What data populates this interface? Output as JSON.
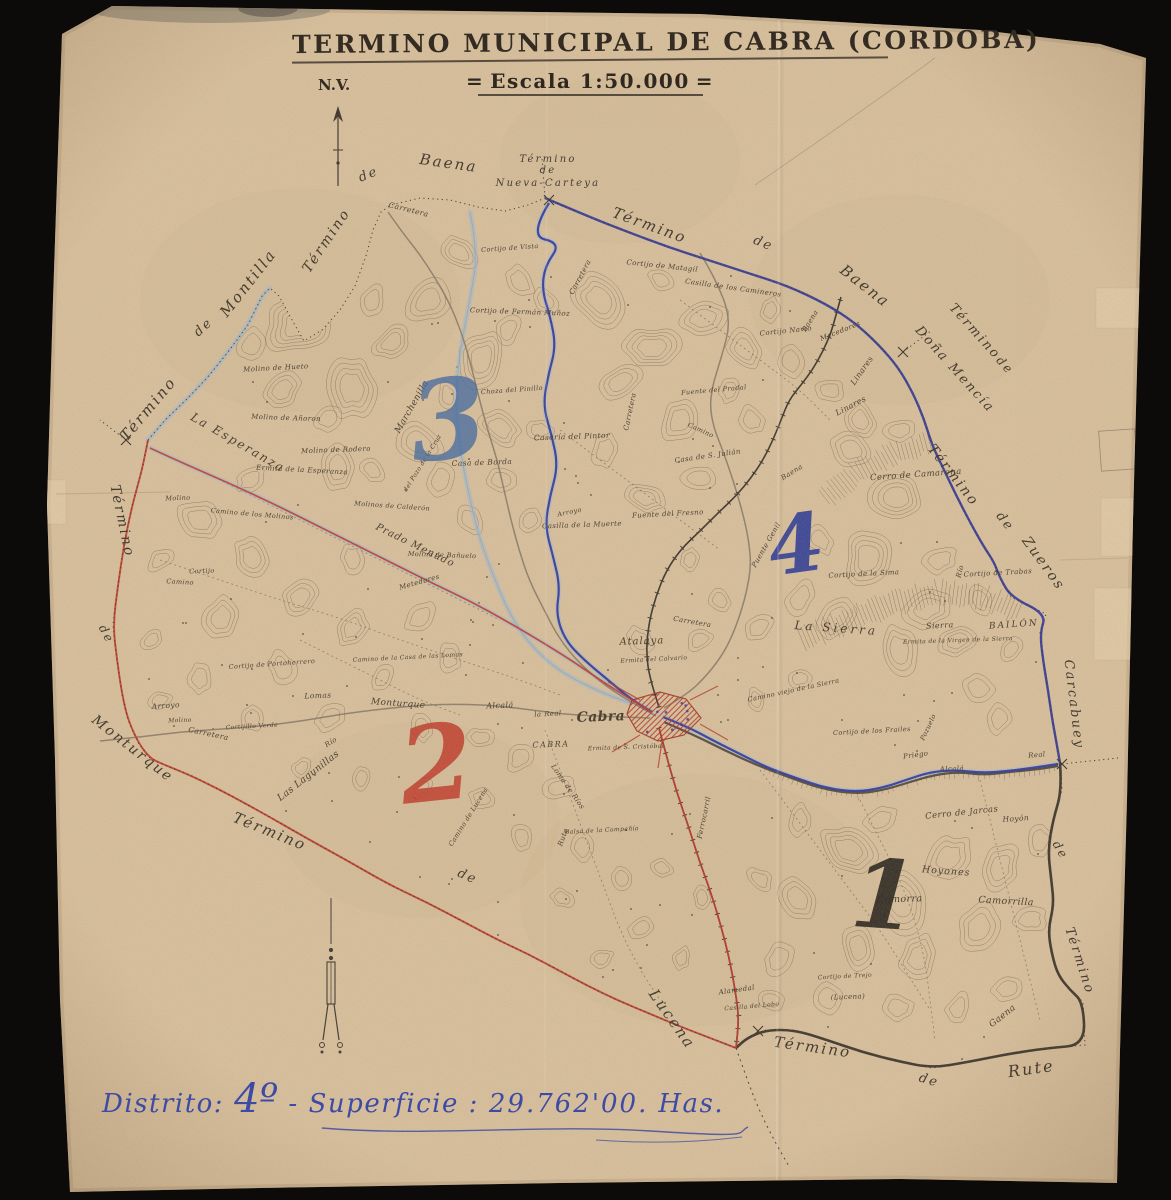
{
  "document": {
    "title": "TERMINO MUNICIPAL DE CABRA (CORDOBA)",
    "scale": "Escala 1:50.000",
    "scale_decor": "=",
    "north_indicator": "N.V."
  },
  "footer": {
    "prefix": "Distrito:",
    "district": "4º",
    "separator": "-",
    "surface_label": "Superficie :",
    "surface_value": "29.762'00.",
    "unit": "Has."
  },
  "map": {
    "colors": {
      "background": "#0c0b09",
      "paper": "#d9c19f",
      "ink": "#443a2d",
      "contour": "#86715a",
      "boundary_blue": "#2c35a0",
      "boundary_red": "#c23a2c",
      "boundary_black": "#37302a",
      "stream_blue": "#9fb9d4",
      "road": "#877a67",
      "footer_ink": "#3e4ba5"
    },
    "districts": [
      {
        "label": "1",
        "x": 882,
        "y": 928,
        "size": 95,
        "rot": 4,
        "color": "#2a2520",
        "opacity": 0.92
      },
      {
        "label": "2",
        "x": 440,
        "y": 800,
        "size": 105,
        "rot": -6,
        "color": "#c23a2c",
        "opacity": 0.85
      },
      {
        "label": "3",
        "x": 452,
        "y": 458,
        "size": 110,
        "rot": -6,
        "color": "#4169a4",
        "opacity": 0.78
      },
      {
        "label": "4",
        "x": 800,
        "y": 572,
        "size": 80,
        "rot": -8,
        "color": "#2b3a99",
        "opacity": 0.9
      }
    ],
    "neighbor_labels": [
      {
        "t": "Término",
        "x": 152,
        "y": 412,
        "r": -50,
        "s": 15
      },
      {
        "t": "de",
        "x": 206,
        "y": 330,
        "r": -42,
        "s": 13
      },
      {
        "t": "Montilla",
        "x": 252,
        "y": 286,
        "r": -52,
        "s": 15
      },
      {
        "t": "Término",
        "x": 330,
        "y": 243,
        "r": -56,
        "s": 14
      },
      {
        "t": "de",
        "x": 370,
        "y": 178,
        "r": -22,
        "s": 13
      },
      {
        "t": "Baena",
        "x": 448,
        "y": 168,
        "r": 8,
        "s": 15
      },
      {
        "t": "Término",
        "x": 548,
        "y": 162,
        "r": 0,
        "s": 10
      },
      {
        "t": "de",
        "x": 548,
        "y": 173,
        "r": 0,
        "s": 10
      },
      {
        "t": "Nueva-Carteya",
        "x": 548,
        "y": 186,
        "r": 0,
        "s": 10
      },
      {
        "t": "Término",
        "x": 648,
        "y": 230,
        "r": 20,
        "s": 15
      },
      {
        "t": "de",
        "x": 762,
        "y": 247,
        "r": 22,
        "s": 13
      },
      {
        "t": "Baena",
        "x": 862,
        "y": 290,
        "r": 38,
        "s": 15
      },
      {
        "t": "Término",
        "x": 972,
        "y": 334,
        "r": 48,
        "s": 13
      },
      {
        "t": "de",
        "x": 1002,
        "y": 368,
        "r": 48,
        "s": 12
      },
      {
        "t": "Doña Mencía",
        "x": 952,
        "y": 372,
        "r": 48,
        "s": 13
      },
      {
        "t": "Término",
        "x": 950,
        "y": 478,
        "r": 52,
        "s": 14
      },
      {
        "t": "de",
        "x": 1002,
        "y": 524,
        "r": 52,
        "s": 13
      },
      {
        "t": "Zueros",
        "x": 1040,
        "y": 566,
        "r": 54,
        "s": 14
      },
      {
        "t": "Carcabuey",
        "x": 1070,
        "y": 705,
        "r": 83,
        "s": 13
      },
      {
        "t": "de",
        "x": 1057,
        "y": 852,
        "r": 60,
        "s": 12
      },
      {
        "t": "Término",
        "x": 1076,
        "y": 962,
        "r": 72,
        "s": 13
      },
      {
        "t": "Término",
        "x": 812,
        "y": 1052,
        "r": 8,
        "s": 15
      },
      {
        "t": "de",
        "x": 928,
        "y": 1084,
        "r": 16,
        "s": 13
      },
      {
        "t": "Rute",
        "x": 1032,
        "y": 1074,
        "r": -8,
        "s": 16
      },
      {
        "t": "Término",
        "x": 268,
        "y": 836,
        "r": 22,
        "s": 15
      },
      {
        "t": "de",
        "x": 466,
        "y": 880,
        "r": 24,
        "s": 13
      },
      {
        "t": "Lucena",
        "x": 668,
        "y": 1022,
        "r": 55,
        "s": 15
      },
      {
        "t": "Término",
        "x": 118,
        "y": 522,
        "r": 78,
        "s": 14
      },
      {
        "t": "de",
        "x": 103,
        "y": 636,
        "r": 62,
        "s": 12
      },
      {
        "t": "Monturque",
        "x": 130,
        "y": 752,
        "r": 38,
        "s": 14
      }
    ],
    "place_labels": [
      {
        "t": "Carretera",
        "x": 408,
        "y": 212,
        "r": 14,
        "s": 7.5
      },
      {
        "t": "Cortijo de Vista",
        "x": 510,
        "y": 250,
        "r": -4,
        "s": 6.5
      },
      {
        "t": "Carretera",
        "x": 582,
        "y": 278,
        "r": -62,
        "s": 7
      },
      {
        "t": "Cortijo de Matagil",
        "x": 662,
        "y": 268,
        "r": 6,
        "s": 7
      },
      {
        "t": "Casilla de los Camineros",
        "x": 733,
        "y": 290,
        "r": 8,
        "s": 7
      },
      {
        "t": "Cortijo Navío",
        "x": 786,
        "y": 333,
        "r": -6,
        "s": 7
      },
      {
        "t": "Mecedores",
        "x": 841,
        "y": 333,
        "r": -22,
        "s": 7
      },
      {
        "t": "Baena",
        "x": 812,
        "y": 322,
        "r": -58,
        "s": 7
      },
      {
        "t": "Linares",
        "x": 864,
        "y": 372,
        "r": -55,
        "s": 8
      },
      {
        "t": "Linares",
        "x": 852,
        "y": 408,
        "r": -28,
        "s": 8
      },
      {
        "t": "Cortijo de Fermán Muñoz",
        "x": 520,
        "y": 314,
        "r": 2,
        "s": 7
      },
      {
        "t": "Molino de Hueto",
        "x": 276,
        "y": 370,
        "r": -3,
        "s": 7
      },
      {
        "t": "Molino de Añoron",
        "x": 286,
        "y": 420,
        "r": 2,
        "s": 7
      },
      {
        "t": "Marchenilla",
        "x": 414,
        "y": 408,
        "r": -60,
        "s": 9
      },
      {
        "t": "Choza del Pinillo",
        "x": 512,
        "y": 392,
        "r": -4,
        "s": 6.5
      },
      {
        "t": "Molino de Rodero",
        "x": 336,
        "y": 452,
        "r": -2,
        "s": 7
      },
      {
        "t": "Ermita de la Esperanza",
        "x": 302,
        "y": 472,
        "r": 3,
        "s": 7
      },
      {
        "t": "La Esperanza",
        "x": 236,
        "y": 446,
        "r": 30,
        "s": 12,
        "ls": 2
      },
      {
        "t": "Casa de Borda",
        "x": 482,
        "y": 465,
        "r": -2,
        "s": 7.5
      },
      {
        "t": "del Pozo de la Cruz",
        "x": 424,
        "y": 464,
        "r": -58,
        "s": 6
      },
      {
        "t": "Casería del Pintor",
        "x": 572,
        "y": 439,
        "r": -2,
        "s": 7.5
      },
      {
        "t": "Molinos de Calderón",
        "x": 392,
        "y": 508,
        "r": 4,
        "s": 6.5
      },
      {
        "t": "Camino de los Molinos",
        "x": 252,
        "y": 516,
        "r": 5,
        "s": 6.5
      },
      {
        "t": "Molino",
        "x": 178,
        "y": 500,
        "r": -2,
        "s": 6.5
      },
      {
        "t": "Prado Menudo",
        "x": 414,
        "y": 548,
        "r": 26,
        "s": 10,
        "ls": 1
      },
      {
        "t": "Molino de Bañuelo",
        "x": 442,
        "y": 557,
        "r": 2,
        "s": 6.5
      },
      {
        "t": "Arroyo",
        "x": 570,
        "y": 514,
        "r": -12,
        "s": 6.5
      },
      {
        "t": "Casilla de la Muerte",
        "x": 582,
        "y": 527,
        "r": -2,
        "s": 7
      },
      {
        "t": "Fuente del Fresno",
        "x": 668,
        "y": 516,
        "r": -3,
        "s": 7
      },
      {
        "t": "Fuente del Pradal",
        "x": 714,
        "y": 392,
        "r": -5,
        "s": 6.5
      },
      {
        "t": "Casa de S. Julián",
        "x": 708,
        "y": 458,
        "r": -8,
        "s": 7
      },
      {
        "t": "Camino",
        "x": 700,
        "y": 432,
        "r": 25,
        "s": 6.5
      },
      {
        "t": "Cerro de Camarena",
        "x": 916,
        "y": 477,
        "r": -4,
        "s": 8.5
      },
      {
        "t": "Cortijo de la Sima",
        "x": 864,
        "y": 576,
        "r": -3,
        "s": 7
      },
      {
        "t": "Río",
        "x": 962,
        "y": 572,
        "r": -75,
        "s": 7
      },
      {
        "t": "Cortijo de Trabas",
        "x": 998,
        "y": 575,
        "r": -3,
        "s": 7
      },
      {
        "t": "La Sierra",
        "x": 836,
        "y": 632,
        "r": 4,
        "s": 12,
        "ls": 3
      },
      {
        "t": "Sierra",
        "x": 940,
        "y": 628,
        "r": -3,
        "s": 8
      },
      {
        "t": "Ermita de la Virgen de la Sierra",
        "x": 958,
        "y": 642,
        "r": -2,
        "s": 6
      },
      {
        "t": "BAILÓN",
        "x": 1014,
        "y": 627,
        "r": -4,
        "s": 9,
        "ls": 2
      },
      {
        "t": "Puente Genil",
        "x": 768,
        "y": 546,
        "r": -60,
        "s": 7
      },
      {
        "t": "Baena",
        "x": 793,
        "y": 474,
        "r": -32,
        "s": 7
      },
      {
        "t": "Camino viejo de la Sierra",
        "x": 794,
        "y": 692,
        "r": -12,
        "s": 6.5
      },
      {
        "t": "Carretera",
        "x": 692,
        "y": 624,
        "r": 10,
        "s": 7
      },
      {
        "t": "Carretera",
        "x": 632,
        "y": 412,
        "r": -78,
        "s": 7
      },
      {
        "t": "Atalaya",
        "x": 642,
        "y": 644,
        "r": -2,
        "s": 10,
        "ls": 1
      },
      {
        "t": "Ermita del Calvario",
        "x": 654,
        "y": 661,
        "r": -3,
        "s": 6
      },
      {
        "t": "Cabra",
        "x": 601,
        "y": 721,
        "r": -2,
        "s": 14,
        "b": 1
      },
      {
        "t": "CABRA",
        "x": 551,
        "y": 747,
        "r": -2,
        "s": 8,
        "ls": 1.5
      },
      {
        "t": "Ermita de S. Cristóbal",
        "x": 626,
        "y": 749,
        "r": -2,
        "s": 6
      },
      {
        "t": "Loma de Ríos",
        "x": 566,
        "y": 788,
        "r": 55,
        "s": 7
      },
      {
        "t": "la Real",
        "x": 548,
        "y": 716,
        "r": -3,
        "s": 7
      },
      {
        "t": "Alcalá",
        "x": 500,
        "y": 708,
        "r": -2,
        "s": 8
      },
      {
        "t": "Monturque",
        "x": 398,
        "y": 706,
        "r": 4,
        "s": 9
      },
      {
        "t": "Cortijo",
        "x": 202,
        "y": 573,
        "r": -2,
        "s": 6.5
      },
      {
        "t": "Camino",
        "x": 180,
        "y": 584,
        "r": 3,
        "s": 6.5
      },
      {
        "t": "Cortijo de Portoherrero",
        "x": 272,
        "y": 666,
        "r": -4,
        "s": 6.5
      },
      {
        "t": "Camino de la Casa de las Lomas",
        "x": 408,
        "y": 659,
        "r": -3,
        "s": 6
      },
      {
        "t": "Metedores",
        "x": 420,
        "y": 584,
        "r": -16,
        "s": 7
      },
      {
        "t": "Lomas",
        "x": 318,
        "y": 698,
        "r": -2,
        "s": 7.5
      },
      {
        "t": "Arroyo",
        "x": 166,
        "y": 708,
        "r": -4,
        "s": 7.5
      },
      {
        "t": "Molino",
        "x": 180,
        "y": 722,
        "r": -2,
        "s": 6
      },
      {
        "t": "Cortijillo Verde",
        "x": 252,
        "y": 728,
        "r": -3,
        "s": 6
      },
      {
        "t": "Carretera",
        "x": 208,
        "y": 736,
        "r": 12,
        "s": 7.5
      },
      {
        "t": "Río",
        "x": 332,
        "y": 744,
        "r": -32,
        "s": 7
      },
      {
        "t": "Las Lagunillas",
        "x": 310,
        "y": 778,
        "r": -38,
        "s": 9.5
      },
      {
        "t": "Camino de Lucena",
        "x": 470,
        "y": 818,
        "r": -58,
        "s": 6.5
      },
      {
        "t": "Rute",
        "x": 565,
        "y": 838,
        "r": -70,
        "s": 7
      },
      {
        "t": "Balsa de la Compañía",
        "x": 602,
        "y": 832,
        "r": -3,
        "s": 6
      },
      {
        "t": "Ferrocarril",
        "x": 706,
        "y": 818,
        "r": -78,
        "s": 7
      },
      {
        "t": "Alamedal",
        "x": 737,
        "y": 992,
        "r": -8,
        "s": 7
      },
      {
        "t": "Casilla del Lobo",
        "x": 752,
        "y": 1008,
        "r": -5,
        "s": 6
      },
      {
        "t": "Cortijo de los Frailes",
        "x": 872,
        "y": 733,
        "r": -3,
        "s": 6.5
      },
      {
        "t": "Pozuelo",
        "x": 930,
        "y": 728,
        "r": -65,
        "s": 6.5
      },
      {
        "t": "Priego",
        "x": 916,
        "y": 757,
        "r": -8,
        "s": 7
      },
      {
        "t": "Alcalá",
        "x": 952,
        "y": 771,
        "r": -2,
        "s": 7
      },
      {
        "t": "Real",
        "x": 1037,
        "y": 757,
        "r": -5,
        "s": 7
      },
      {
        "t": "Cerro de Jarcas",
        "x": 962,
        "y": 815,
        "r": -6,
        "s": 8.5
      },
      {
        "t": "Hoyón",
        "x": 1016,
        "y": 821,
        "r": -4,
        "s": 7.5
      },
      {
        "t": "Hoyones",
        "x": 946,
        "y": 874,
        "r": 4,
        "s": 9.5,
        "ls": 1
      },
      {
        "t": "Camorra",
        "x": 900,
        "y": 902,
        "r": -2,
        "s": 9.5
      },
      {
        "t": "Camorrilla",
        "x": 1006,
        "y": 904,
        "r": 3,
        "s": 9.5
      },
      {
        "t": "Gaena",
        "x": 1004,
        "y": 1018,
        "r": -38,
        "s": 9
      },
      {
        "t": "(Lucena)",
        "x": 848,
        "y": 999,
        "r": -2,
        "s": 7
      },
      {
        "t": "Cortijo de Trejo",
        "x": 845,
        "y": 978,
        "r": -3,
        "s": 6
      }
    ]
  }
}
